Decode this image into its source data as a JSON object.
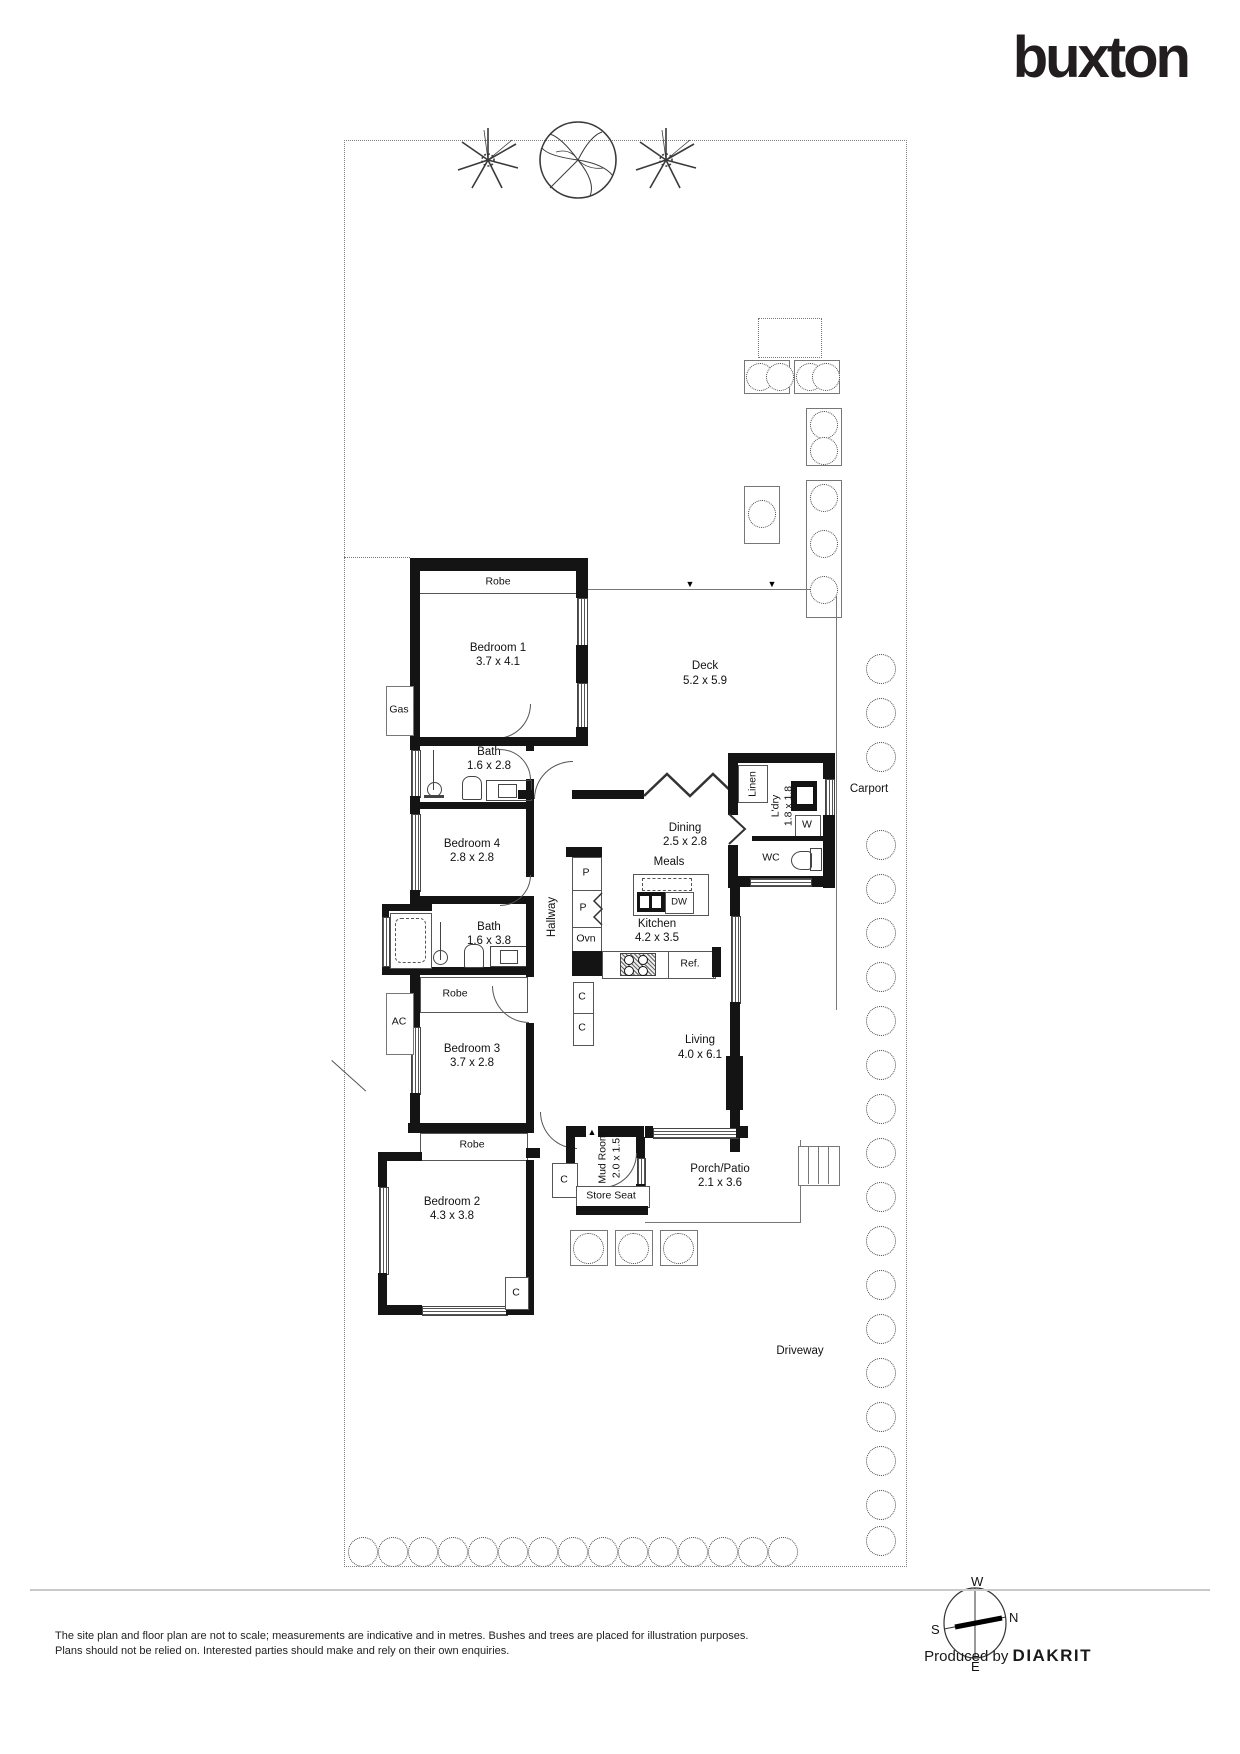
{
  "brand": {
    "logo_text": "buxton"
  },
  "rooms": {
    "bedroom1": {
      "name": "Bedroom 1",
      "dims": "3.7 x 4.1"
    },
    "bedroom2": {
      "name": "Bedroom 2",
      "dims": "4.3 x 3.8"
    },
    "bedroom3": {
      "name": "Bedroom 3",
      "dims": "3.7 x 2.8"
    },
    "bedroom4": {
      "name": "Bedroom 4",
      "dims": "2.8 x 2.8"
    },
    "bath1": {
      "name": "Bath",
      "dims": "1.6 x 2.8"
    },
    "bath2": {
      "name": "Bath",
      "dims": "1.6 x 3.8"
    },
    "kitchen": {
      "name": "Kitchen",
      "dims": "4.2 x 3.5"
    },
    "dining": {
      "name": "Dining",
      "dims": "2.5 x 2.8"
    },
    "living": {
      "name": "Living",
      "dims": "4.0 x 6.1"
    },
    "meals": {
      "name": "Meals"
    },
    "hallway": {
      "name": "Hallway"
    },
    "deck": {
      "name": "Deck",
      "dims": "5.2 x 5.9"
    },
    "laundry": {
      "name": "L'dry",
      "dims": "1.8 x 1.8"
    },
    "linen": {
      "name": "Linen"
    },
    "wc": {
      "name": "WC"
    },
    "mudroom": {
      "name": "Mud Room",
      "dims": "2.0 x 1.5"
    },
    "porch": {
      "name": "Porch/Patio",
      "dims": "2.1 x 3.6"
    },
    "storeseat": {
      "name": "Store Seat"
    },
    "carport": {
      "name": "Carport"
    },
    "driveway": {
      "name": "Driveway"
    }
  },
  "fixtures": {
    "robe": "Robe",
    "gas": "Gas",
    "ac": "AC",
    "pantry": "P",
    "oven": "Ovn",
    "cupboard": "C",
    "fridge": "Ref.",
    "dishwasher": "DW",
    "washer": "W"
  },
  "markers": {
    "entry_down": "▼",
    "entry_up": "▲"
  },
  "compass": {
    "n": "N",
    "s": "S",
    "e": "E",
    "w": "W"
  },
  "footer": {
    "disclaimer_line1": "The site plan and floor plan are not to scale; measurements are indicative and in metres. Bushes and trees are placed for illustration purposes.",
    "disclaimer_line2": "Plans should not be relied on. Interested parties should make and rely on their own enquiries.",
    "produced_by": "Produced by ",
    "producer": "DIAKRIT"
  },
  "colors": {
    "wall": "#141414",
    "line": "#777777",
    "logo": "#221e1f"
  }
}
